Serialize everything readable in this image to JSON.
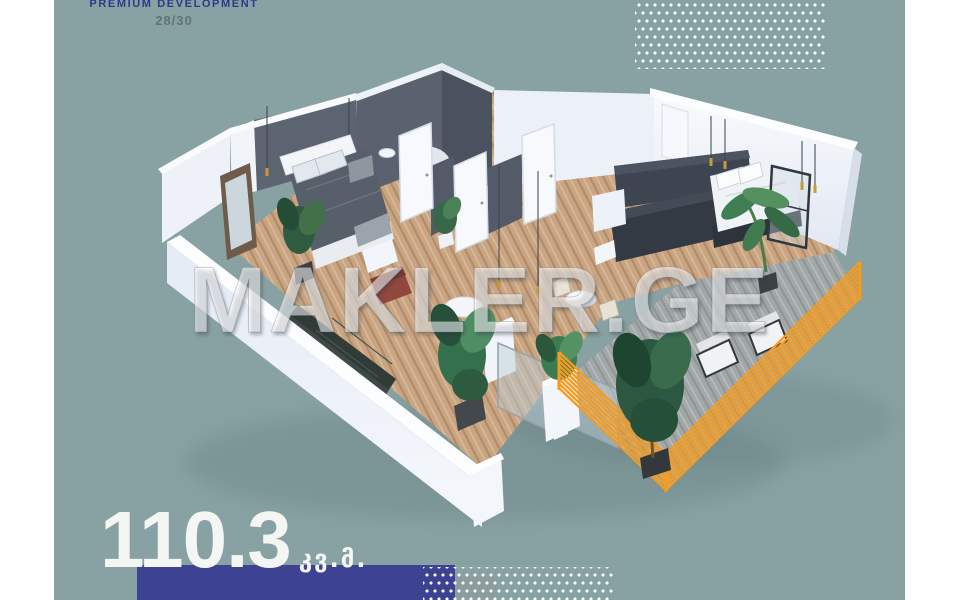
{
  "header": {
    "title": "PREMIUM DEVELOPMENT",
    "subtitle": "28/30"
  },
  "watermark": {
    "text": "MAKLER.GE"
  },
  "area": {
    "value": "110.3",
    "unit": "კვ.მ."
  },
  "floor_plan": {
    "description": "3D isometric render of an apartment: bedroom with double bed, bathroom core with dark grey walls and white doors, living area with dark kitchen unit and second bed, terrace with glass balustrade, large balcony with orange slatted railing, wooden parquet floors, potted plants and pendant lights"
  },
  "colors": {
    "canvas_teal": "#88A1A2",
    "title_navy": "#2D398C",
    "subtitle_gray": "#5E7478",
    "bar_navy": "#3E4292",
    "gray_square": "#8D9C9E",
    "balcony_orange": "#F59B1E",
    "dots_white": "#FFFFFF",
    "wood_floor": "#C9A583",
    "deck_gray": "#A2A8A8",
    "dark_wall": "#59626E"
  }
}
